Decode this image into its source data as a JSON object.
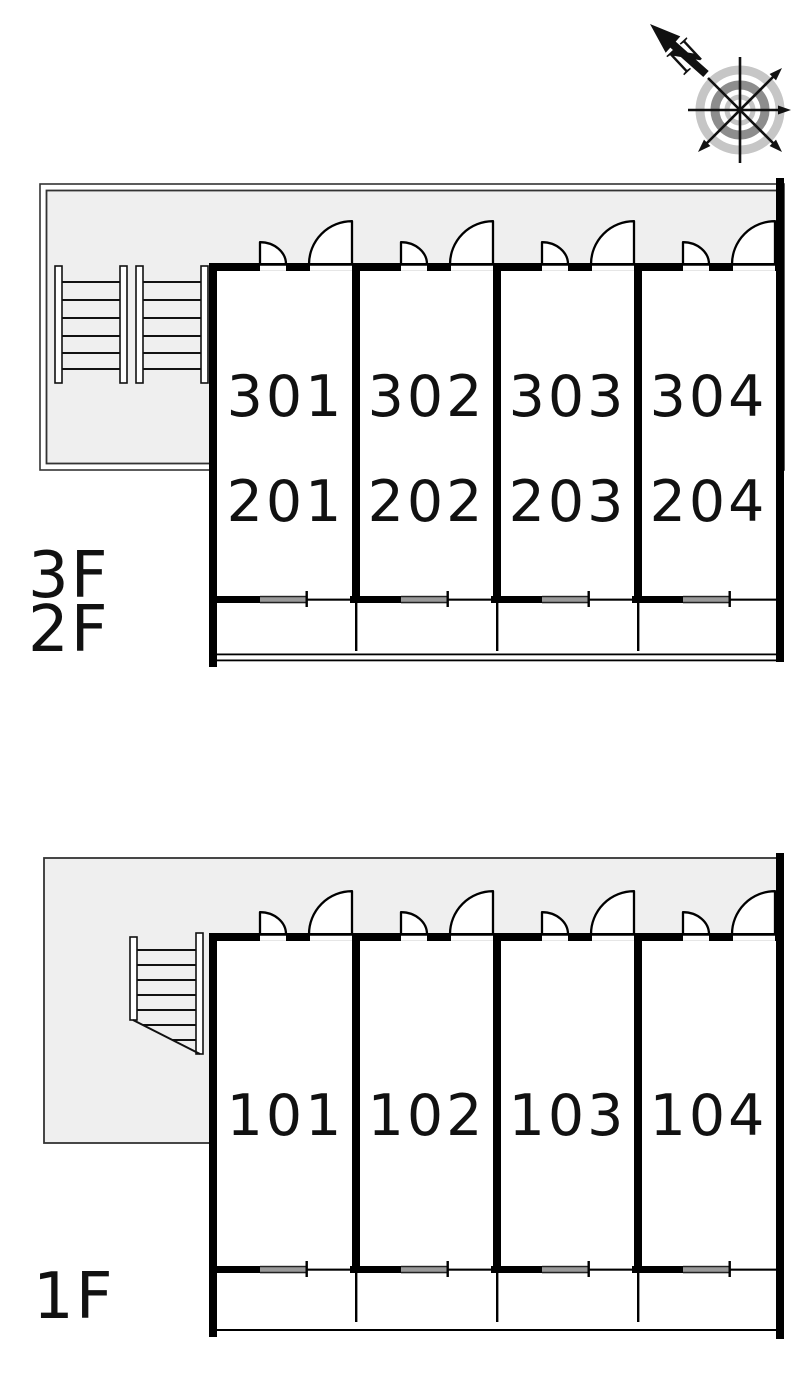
{
  "compass": {
    "north_label": "N"
  },
  "plans": {
    "upper": {
      "floor_labels": [
        "3F",
        "2F"
      ],
      "unit_rows": [
        {
          "floor": "3F",
          "units": [
            "301",
            "302",
            "303",
            "304"
          ]
        },
        {
          "floor": "2F",
          "units": [
            "201",
            "202",
            "203",
            "204"
          ]
        }
      ]
    },
    "first": {
      "floor_labels": [
        "1F"
      ],
      "unit_rows": [
        {
          "floor": "1F",
          "units": [
            "101",
            "102",
            "103",
            "104"
          ]
        }
      ]
    }
  },
  "colors": {
    "area_fill": "#efefef",
    "wall": "#000000",
    "window_glass": "#999999",
    "compass_light": "#c6c6c6",
    "compass_dark": "#8d8d8d"
  }
}
